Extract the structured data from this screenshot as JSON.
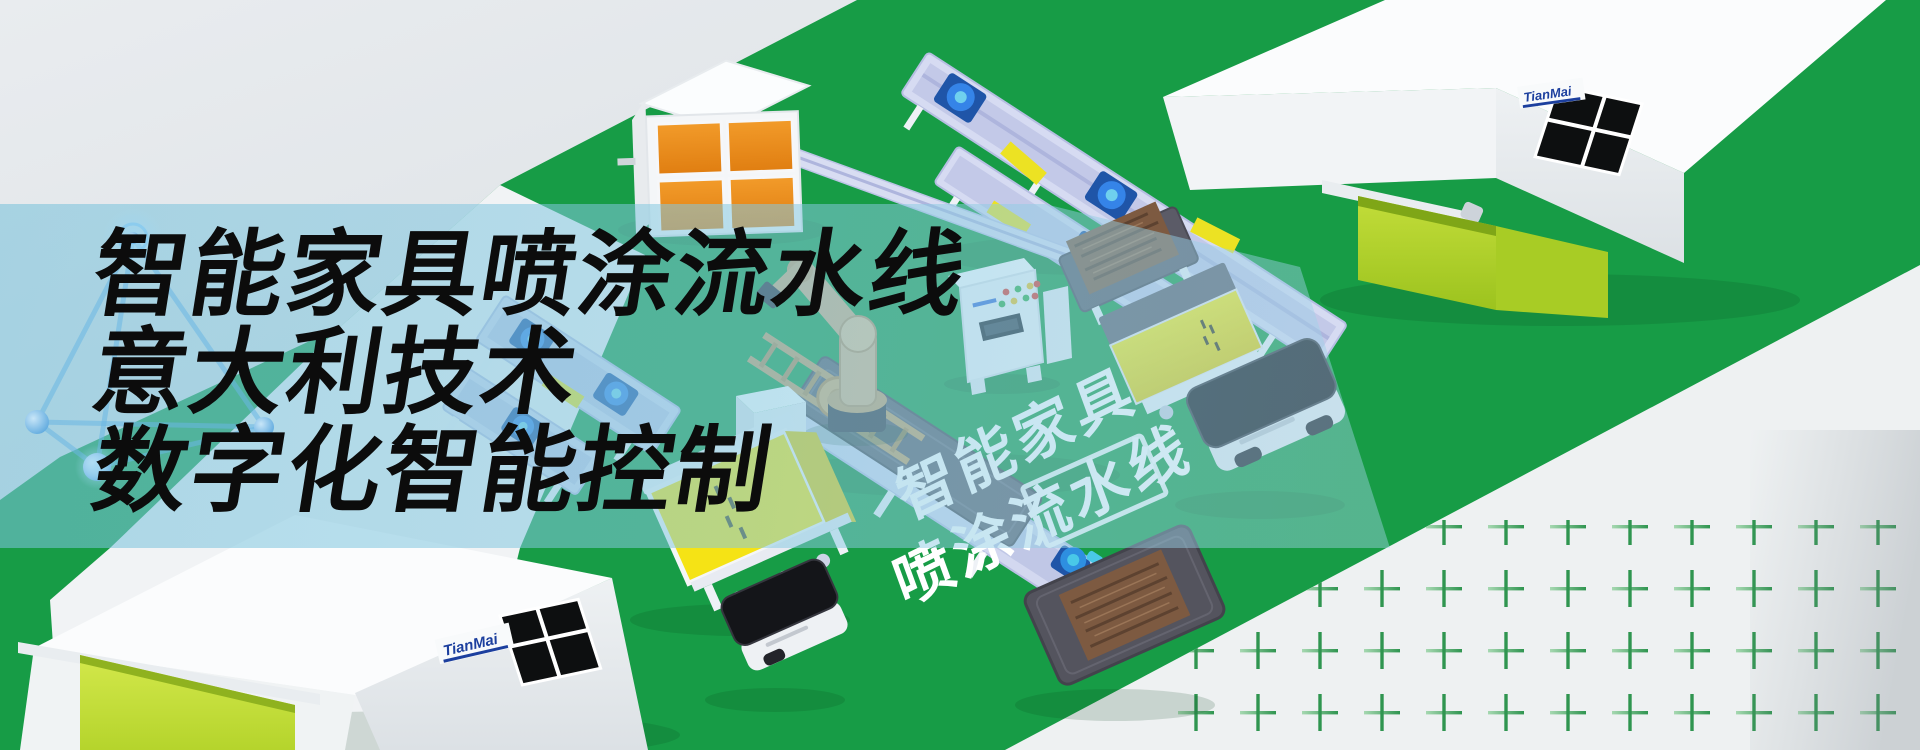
{
  "banner": {
    "headline": {
      "line1": "智能家具喷涂流水线",
      "line2": "意大利技术",
      "line3": "数字化智能控制"
    },
    "floor_caption": {
      "line1": "智能家具",
      "line2": "喷涂流水线"
    },
    "brand_logo": "TianMai",
    "colors": {
      "floor_green": "#179c46",
      "floor_gray": "#e6e9ec",
      "overlay_blue": "#7dc1dc",
      "booth_orange": "#ee8c1d",
      "machine_yellow": "#f5e315",
      "door_green_left": "#c6e03c",
      "door_green_right": "#b2d42c",
      "frame_silver": "#d3d8f0",
      "motor_blue": "#2f80dd",
      "robot_tan": "#d7b287",
      "wood_brown": "#7d5a41",
      "plus_mark_green": "#2f9550",
      "logo_blue": "#1c3f9e",
      "headline_black": "#0c0c0c",
      "caption_white": "#ffffff"
    }
  }
}
